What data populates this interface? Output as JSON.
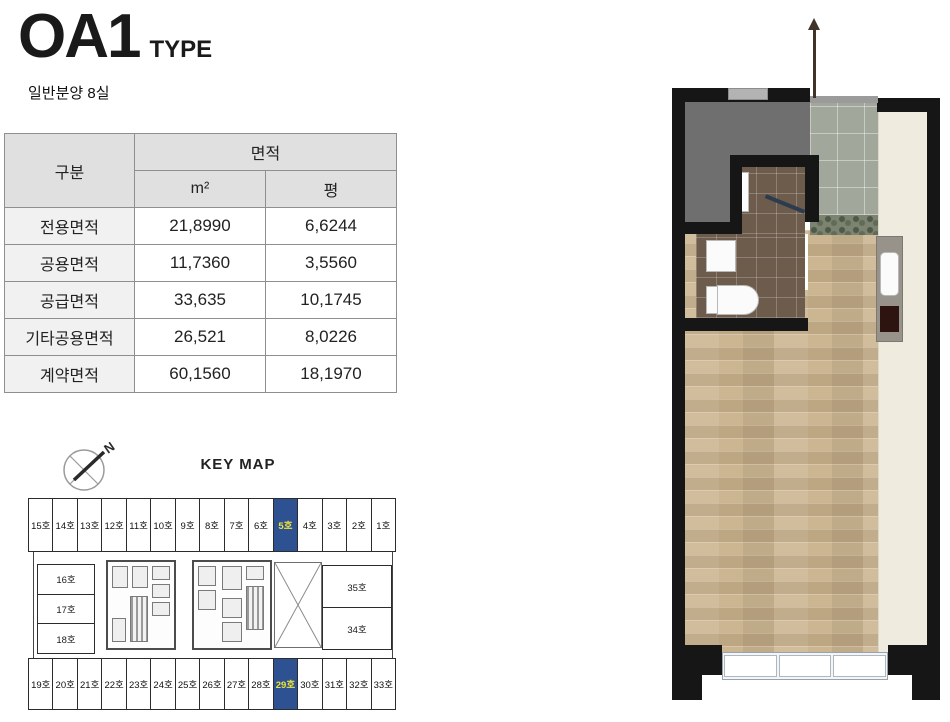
{
  "header": {
    "title": "OA1",
    "title_suffix": "TYPE",
    "subtitle": "일반분양 8실"
  },
  "area_table": {
    "row_header": "구분",
    "col_group_header": "면적",
    "unit_headers": [
      "m²",
      "평"
    ],
    "rows": [
      {
        "label": "전용면적",
        "m2": "21,8990",
        "pyeong": "6,6244"
      },
      {
        "label": "공용면적",
        "m2": "11,7360",
        "pyeong": "3,5560"
      },
      {
        "label": "공급면적",
        "m2": "33,635",
        "pyeong": "10,1745"
      },
      {
        "label": "기타공용면적",
        "m2": "26,521",
        "pyeong": "8,0226"
      },
      {
        "label": "계약면적",
        "m2": "60,1560",
        "pyeong": "18,1970"
      }
    ]
  },
  "keymap": {
    "title": "KEY MAP",
    "compass_label": "N",
    "top_row": [
      "15호",
      "14호",
      "13호",
      "12호",
      "11호",
      "10호",
      "9호",
      "8호",
      "7호",
      "6호",
      "5호",
      "4호",
      "3호",
      "2호",
      "1호"
    ],
    "bottom_row": [
      "19호",
      "20호",
      "21호",
      "22호",
      "23호",
      "24호",
      "25호",
      "26호",
      "27호",
      "28호",
      "29호",
      "30호",
      "31호",
      "32호",
      "33호"
    ],
    "left_units": [
      "16호",
      "17호",
      "18호"
    ],
    "right_units": [
      "35호",
      "34호"
    ],
    "highlighted_units": [
      "5호",
      "29호"
    ]
  },
  "colors": {
    "highlight_bg": "#2e5191",
    "highlight_text": "#ece437",
    "wall": "#161616",
    "wood_floor": "#ccb691",
    "entry_tile": "#a2a79b",
    "bath_tile": "#6d5b4c",
    "utility_room": "#6f6f6f",
    "closet_strip": "#efecdf"
  }
}
